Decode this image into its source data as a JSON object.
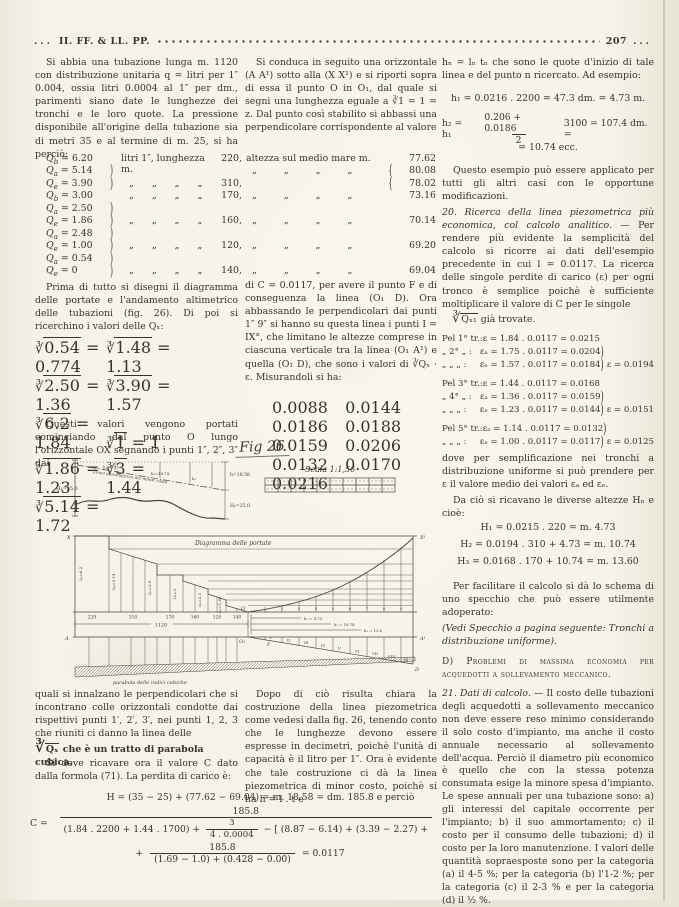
{
  "header": {
    "dots_left": "...",
    "journal": "II. FF. & LL. PP.",
    "page": "207",
    "dots_right": "..."
  },
  "col1": {
    "p1": "Si abbia una tubazione lunga m. 1120 con distribuzione unitaria q = litri per 1″ 0.004, ossia litri 0.0004 al 1″ per dm., parimenti siano date le lunghezze dei tronchi e le loro quote. La pressione disponibile all'origine della tubazione sia di metri 35 e al termine di m. 25, si ha perciò:",
    "qtable": [
      {
        "cls": "qrow",
        "sub": "b",
        "val": "= 6.20",
        "brace": "",
        "mid": "litri 1″, lunghezza m.",
        "len": "220,"
      },
      {
        "cls": "qrow",
        "sub": "a",
        "val": "= 5.14",
        "brace": ")",
        "mid": "",
        "len": ""
      },
      {
        "cls": "qrow dit",
        "sub": "e",
        "val": "= 3.90",
        "brace": ")",
        "mid": "„ „ „ „",
        "len": "310,"
      },
      {
        "cls": "qrow dit",
        "sub": "b",
        "val": "= 3.00",
        "brace": "",
        "mid": "„ „ „ „",
        "len": "170,"
      },
      {
        "cls": "qrow",
        "sub": "a",
        "val": "= 2.50",
        "brace": ")",
        "mid": "",
        "len": ""
      },
      {
        "cls": "qrow dit",
        "sub": "e",
        "val": "= 1.86",
        "brace": ")",
        "mid": "„ „ „ „",
        "len": "160,"
      },
      {
        "cls": "qrow",
        "sub": "a",
        "val": "= 2.48",
        "brace": ")",
        "mid": "",
        "len": ""
      },
      {
        "cls": "qrow dit",
        "sub": "e",
        "val": "= 1.00",
        "brace": ")",
        "mid": "„ „ „ „",
        "len": "120,"
      },
      {
        "cls": "qrow",
        "sub": "a",
        "val": "= 0.54",
        "brace": ")",
        "mid": "",
        "len": ""
      },
      {
        "cls": "qrow dit",
        "sub": "e",
        "val": "= 0",
        "brace": ")",
        "mid": "„ „ „ „",
        "len": "140,"
      }
    ],
    "p2": "Prima di tutto si disegni il diagramma delle portate e l'andamento altimetrico delle tubazioni (fig. 26). Di poi si ricerchino i valori delle Qₓ:",
    "roots": [
      {
        "rad": "0.54",
        "val": "= 0.774"
      },
      {
        "rad": "1.48",
        "val": "= 1.13"
      },
      {
        "rad": "2.50",
        "val": "= 1.36"
      },
      {
        "rad": "3.90",
        "val": "= 1.57"
      },
      {
        "rad": "6.2",
        "val": "= 1.84"
      },
      {
        "rad": "1",
        "val": "= 1"
      },
      {
        "rad": "1.86",
        "val": "= 1.23"
      },
      {
        "rad": "3",
        "val": "= 1.44"
      },
      {
        "rad": "5.14",
        "val": "= 1.72"
      }
    ],
    "p3": "Questi valori vengono portati cominciando dal punto O lungo l'orizzontale OX segnando i punti 1″, 2″, 3″ dai",
    "p4a": "quali si innalzano le perpendicolari che si incontrano colle orizzontali condotte dai rispettivi punti 1′, 2′, 3′, nei punti 1, 2, 3 che riuniti ci danno la linea delle",
    "p4b_rad": "Qₓ",
    "p4b_rest": "che è un tratto di parabola cubica.",
    "p5": "Si deve ricavare ora il valore C dato dalla formola (71). La perdita di carico è:"
  },
  "col2": {
    "p1": "Si conduca in seguito una orizzontale (A A¹) sotto alla (X X¹) e si riporti sopra di essa il punto O in O₁, dal quale si segni una lunghezza eguale a ∛1 = 1 = z. Dal punto così stabilito si abbassi una perpendicolare corrispondente al valore",
    "altezza": [
      {
        "cls": "arow",
        "label": "altezza sul medio mare m.",
        "brace": "",
        "val": "77.62"
      },
      {
        "cls": "arow adit",
        "label": "„ „ „ „",
        "brace": "{",
        "val": "80.08"
      },
      {
        "cls": "arow",
        "label": "",
        "brace": "{",
        "val": "78.02"
      },
      {
        "cls": "arow adit",
        "label": "„ „ „ „",
        "brace": "",
        "val": "73.16"
      },
      {
        "cls": "arow",
        "label": "",
        "brace": "",
        "val": ""
      },
      {
        "cls": "arow adit",
        "label": "„ „ „ „",
        "brace": "",
        "val": "70.14"
      },
      {
        "cls": "arow",
        "label": "",
        "brace": "",
        "val": ""
      },
      {
        "cls": "arow adit",
        "label": "„ „ „ „",
        "brace": "",
        "val": "69.20"
      },
      {
        "cls": "arow",
        "label": "",
        "brace": "",
        "val": ""
      },
      {
        "cls": "arow adit",
        "label": "„ „ „ „",
        "brace": "",
        "val": "69.04"
      }
    ],
    "p2": "di C = 0.0117, per avere il punto F e di conseguenza la linea (O₁ D).",
    "p3": "Ora abbassando le perpendicolari dai punti 1″ 9″ si hanno su questa linea i punti I = IX°, che limitano le altezze comprese in ciascuna verticale tra la linea (O₁ A¹) e quella (O₁ D), che sono i valori di ∛Qₓ · ε. Misurandoli si ha:",
    "meas": [
      "0.0088",
      "0.0144",
      "0.0186",
      "0.0188",
      "0.0159",
      "0.0206",
      "0.0132",
      "0.0170",
      "0.0216"
    ],
    "p4": "Dopo di ciò risulta chiara la costruzione della linea piezometrica come vedesi dalla fig. 26, tenendo conto che le lunghezze devono essere espresse in decimetri, poichè l'unità di capacità è il litro per 1″. Ora è evidente che tale costruzione ci dà la linea piezometrica di minor costo, poichè si ha h = l . t e"
  },
  "col3": {
    "p1": "hₙ = lₙ tₙ che sono le quote d'inizio di tale linea e del punto n ricercato. Ad esempio:",
    "eq1": "h₁ = 0.0216 . 2200 = 47.3 dm. = 4.73 m.",
    "eq2": {
      "lead": "h₂ = h₁",
      "num": "0.206 + 0.0186",
      "den": "2",
      "tail": "3100 = 107.4 dm. =",
      "cont": "= 10.74 ecc."
    },
    "p2": "Questo esempio può essere applicato per tutti gli altri casi con le opportune modificazioni.",
    "sec20_head": "20. Ricerca della linea piezometrica più economica, col calcolo analitico. —",
    "sec20_body": " Per rendere più evidente la semplicità del calcolo si ricorre ai dati dell'esempio precedente in cui l = 0.0117. La ricerca delle singole perdite di carico (ε) per ogni tronco è semplice poichè è sufficiente moltiplicare il valore di C per le singole",
    "sec20_rad": "Qₓ₁",
    "sec20_tail": "già trovate.",
    "tr": [
      {
        "cls": "trrow",
        "pre": "Pel 1° tr.:",
        "eq": "ε = 1.84 . 0.0117 = 0.0215",
        "brace": "",
        "res": ""
      },
      {
        "cls": "trrow",
        "pre": "„  2°  „ :",
        "eq": "εₐ = 1.75 . 0.0117 = 0.0204",
        "brace": ")",
        "res": ""
      },
      {
        "cls": "trrow",
        "pre": "„  „  „ :",
        "eq": "εₑ = 1.57 . 0.0117 = 0.0184",
        "brace": ")",
        "res": "ε = 0.0194"
      },
      {
        "cls": "trrow gap",
        "pre": "Pel 3° tr.:",
        "eq": "ε = 1.44 . 0.0117 = 0.0168",
        "brace": "",
        "res": ""
      },
      {
        "cls": "trrow",
        "pre": "„  4°  „ :",
        "eq": "εₐ = 1.36 . 0.0117 = 0.0159",
        "brace": ")",
        "res": ""
      },
      {
        "cls": "trrow",
        "pre": "„  „  „ :",
        "eq": "εₑ = 1.23 . 0.0117 = 0.0144",
        "brace": ")",
        "res": "ε = 0.0151"
      },
      {
        "cls": "trrow gap",
        "pre": "Pel 5° tr.:",
        "eq": "εₐ = 1.14 . 0.0117 = 0.0132",
        "brace": ")",
        "res": ""
      },
      {
        "cls": "trrow",
        "pre": "„  „  „ :",
        "eq": "εₑ = 1.00 . 0.0117 = 0.0117",
        "brace": ")",
        "res": "ε = 0.0125"
      }
    ],
    "p3": "dove per semplificazione nei tronchi a distribuzione uniforme si può prendere per ε il valore medio dei valori εₐ ed εₑ.",
    "p4": "Da ciò si ricavano le diverse altezze Hₙ e cioè:",
    "H": [
      "H₁ = 0.0215 . 220 = m. 4.73",
      "H₂ = 0.0194 . 310 + 4.73 = m. 10.74",
      "H₃ = 0.0168 . 170 + 10.74 = m. 13.60"
    ],
    "p5": "Per facilitare il calcolo si dà lo schema di uno specchio che può essere utilmente adoperato:",
    "p6": "(Vedi Specchio a pagina seguente: Tronchi a distribuzione uniforme).",
    "secD": "D) Problemi di massima economia per acquedotti a sollevamento meccanico.",
    "sec21_head": "21. Dati di calcolo. —",
    "sec21_body": " Il costo delle tubazioni degli acquedotti a sollevamento meccanico non deve essere reso minimo considerando il solo costo d'impianto, ma anche il costo annuale necessario al sollevamento dell'acqua. Perciò il diametro più economico è quello che con la stessa potenza consumata esige la minore spesa d'impianto. Le spese annuali per una tubazione sono: a) gli interessi del capitale occorrente per l'impianto; b) il suo ammortamento; c) il costo per il consumo delle tubazioni; d) il costo per la loro manutenzione. I valori delle quantità sopraesposte sono per la categoria (a) il 4-5 %; per la categoria (b) l'1-2 %; per la categoria (c) il 2-3 % e per la categoria (d) il ½ %."
  },
  "formula": {
    "h_line": "H = (35 − 25) + (77.62 − 69.04) = m. 18.58 = dm. 185.8 e perciò",
    "c_lead": "C =",
    "c_num": "185.8",
    "den_a": "(1.84 . 2200 + 1.44 . 1700) +",
    "den_frac_num": "3",
    "den_frac_den": "4 . 0.0004",
    "den_b": "− [ (8.87 − 6.14) + (3.39 − 2.27) +",
    "l2_plus": "+",
    "l2_num": "185.8",
    "l2_den": "(1.69 − 1.0) + (0.428 − 0.00)",
    "result": "= 0.0117"
  },
  "fig": {
    "title": "Fig 26",
    "scala": "Scala 1:1,56",
    "labels": {
      "H35": "H₁=35,0",
      "piezo": "Linea piezometrica del minor costo",
      "l1": "h₁=4.73",
      "l2": "h₂=10.74",
      "l3": "h₃",
      "h_tot": "h=18.58",
      "H25": "H₂=25,0",
      "diagramma": "Diagramma delle portate",
      "parabola": "parabola delle radici cubiche",
      "total": "1120",
      "O": "O",
      "O1": "O₁",
      "A": "A",
      "A1": "A¹",
      "X": "X",
      "X1": "X¹",
      "D": "D",
      "F": "F"
    },
    "qlabels": [
      "Qₐ=6.2",
      "Qₐ=5.14",
      "Qₑ=3.9",
      "Qₐ=3",
      "Qₐ=2.5",
      "Qₑ=1.86"
    ],
    "distances": [
      "220",
      "310",
      "170",
      "160",
      "120",
      "140"
    ],
    "hdims": [
      "h₁ = 4.73",
      "h₂ = 10.74",
      "h₃ = 13.6"
    ],
    "romans": [
      "I",
      "II",
      "III",
      "IV",
      "V",
      "VI",
      "VII",
      "VIII",
      "IX"
    ],
    "ticks": [
      "1",
      "2",
      "3",
      "4",
      "5",
      "6",
      "7",
      "8",
      "9"
    ]
  }
}
